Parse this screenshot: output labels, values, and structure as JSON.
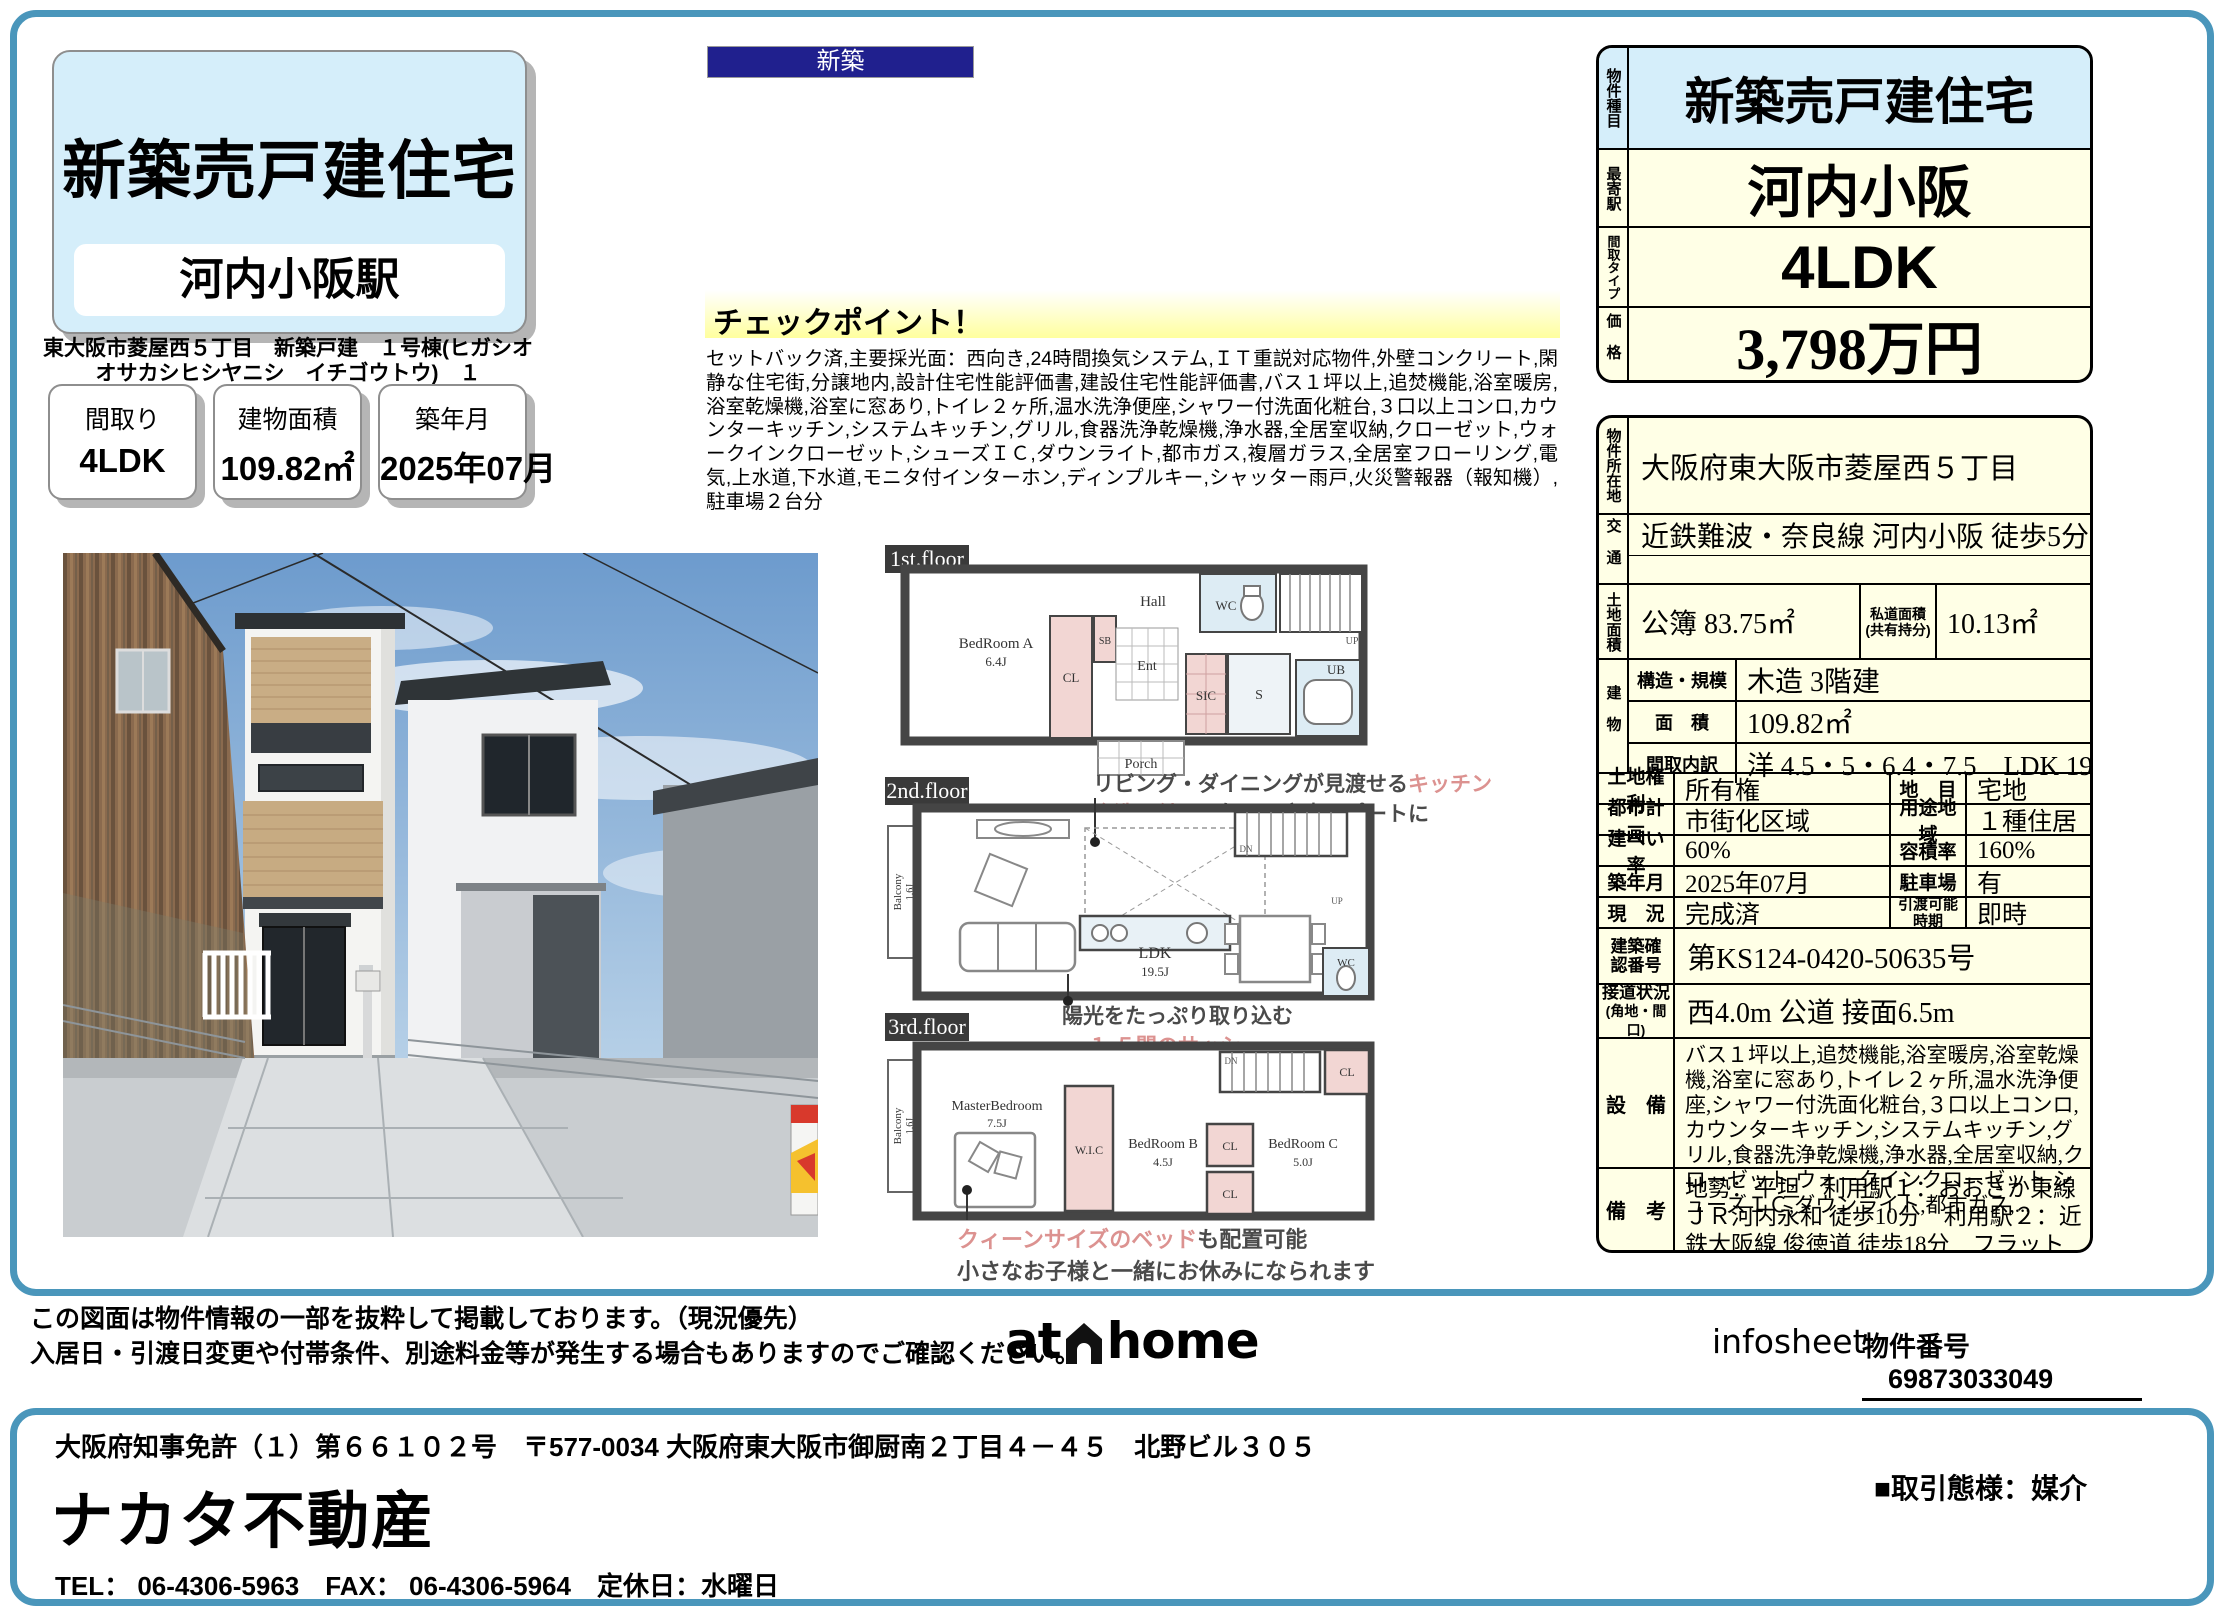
{
  "header": {
    "badge": "新築",
    "title": "新築売戸建住宅",
    "station": "河内小阪駅",
    "address": "東大阪市菱屋西５丁目　新築戸建　１号棟(ヒガシオオサカシヒシヤニシ　イチゴウトウ)　１",
    "stats": [
      {
        "label": "間取り",
        "value": "4LDK"
      },
      {
        "label": "建物面積",
        "value": "109.82㎡"
      },
      {
        "label": "築年月",
        "value": "2025年07月"
      }
    ]
  },
  "checkpoint": {
    "title": "チェックポイント！",
    "body": "セットバック済,主要採光面：西向き,24時間換気システム,ＩＴ重説対応物件,外壁コンクリート,閑静な住宅街,分譲地内,設計住宅性能評価書,建設住宅性能評価書,バス１坪以上,追焚機能,浴室暖房,浴室乾燥機,浴室に窓あり,トイレ２ヶ所,温水洗浄便座,シャワー付洗面化粧台,３口以上コンロ,カウンターキッチン,システムキッチン,グリル,食器洗浄乾燥機,浄水器,全居室収納,クローゼット,ウォークインクローゼット,シューズＩＣ,ダウンライト,都市ガス,複層ガラス,全居室フローリング,電気,上水道,下水道,モニタ付インターホン,ディンプルキー,シャッター雨戸,火災警報器（報知機）,駐車場２台分"
  },
  "summary": {
    "type_label": "物件種目",
    "type_value": "新築売戸建住宅",
    "station_label": "最寄駅",
    "station_value": "河内小阪",
    "layout_label": "間取タイプ",
    "layout_value": "4LDK",
    "price_label": "価格",
    "price_value": "3,798万円"
  },
  "detail": {
    "location": {
      "label": "物件所在地",
      "value": "大阪府東大阪市菱屋西５丁目"
    },
    "access": {
      "label": "交通",
      "value": "近鉄難波・奈良線 河内小阪 徒歩5分"
    },
    "land": {
      "label": "土地面積",
      "value": "公簿 83.75㎡",
      "sub_label1": "私道面積",
      "sub_label2": "(共有持分)",
      "sub_value": "10.13㎡"
    },
    "building": {
      "label": "建物",
      "structure_label": "構造・規模",
      "structure": "木造 3階建",
      "area_label": "面　積",
      "area": "109.82㎡",
      "layout_label": "間取内訳",
      "layout": "洋 4.5・5・6.4・7.5　LDK 19.5"
    },
    "pairs": [
      {
        "l1": "土地権利",
        "v1": "所有権",
        "l2": "地　目",
        "v2": "宅地"
      },
      {
        "l1": "都市計画",
        "v1": "市街化区域",
        "l2": "用途地域",
        "v2": "１種住居"
      },
      {
        "l1": "建ぺい率",
        "v1": "60%",
        "l2": "容積率",
        "v2": "160%"
      },
      {
        "l1": "築年月",
        "v1": "2025年07月",
        "l2": "駐車場",
        "v2": "有"
      },
      {
        "l1": "現　況",
        "v1": "完成済",
        "l2": "引渡可能時期",
        "v2": "即時"
      }
    ],
    "confirm": {
      "label": "建築確認番号",
      "value": "第KS124-0420-50635号"
    },
    "road": {
      "label": "接道状況",
      "label2": "(角地・間口)",
      "value": "西4.0m 公道 接面6.5m"
    },
    "equip": {
      "label": "設　備",
      "value": "バス１坪以上,追焚機能,浴室暖房,浴室乾燥機,浴室に窓あり,トイレ２ヶ所,温水洗浄便座,シャワー付洗面化粧台,３口以上コンロ,カウンターキッチン,システムキッチン,グリル,食器洗浄乾燥機,浄水器,全居室収納,クローゼット,ウォークインクローゼット,シューズＩＣ,ダウンライト,都市ガス,..."
    },
    "notes": {
      "label": "備　考",
      "value": "地勢：平坦　利用駅１：おおさか東線 ＪＲ河内永和 徒歩10分　利用駅２：近鉄大阪線 俊徳道 徒歩18分　フラット35Ｓ適合証明書あり"
    }
  },
  "floors": {
    "f1": {
      "badge": "1st.floor",
      "bedroomA": "BedRoom A",
      "bedroomA_size": "6.4J",
      "hall": "Hall",
      "ent": "Ent",
      "cl": "CL",
      "sb": "SB",
      "sic": "SIC",
      "s": "S",
      "wc": "WC",
      "ub": "UB",
      "porch": "Porch",
      "up": "UP"
    },
    "f2": {
      "badge": "2nd.floor",
      "balcony": "Balcony",
      "balcony_size": "1.6J",
      "ldk": "LDK",
      "ldk_size": "19.5J",
      "wc": "WC",
      "dn": "DN",
      "up": "UP",
      "ann_top_1a": "リビング・ダイニングが見渡せる",
      "ann_top_1b": "キッチン",
      "ann_top_2a": "食洗器付き",
      "ann_top_2b": "で毎日の家事サポートに",
      "ann_bottom_1": "陽光をたっぷり取り込む",
      "ann_bottom_2": "１.５間のサッシ"
    },
    "f3": {
      "badge": "3rd.floor",
      "balcony": "Balcony",
      "balcony_size": "1.6J",
      "master": "MasterBedroom",
      "master_size": "7.5J",
      "wic": "W.I.C",
      "bedroomB": "BedRoom B",
      "bedroomB_size": "4.5J",
      "bedroomC": "BedRoom C",
      "bedroomC_size": "5.0J",
      "cl": "CL",
      "dn": "DN",
      "ann_1a": "クィーンサイズのベッド",
      "ann_1b": "も配置可能",
      "ann_2": "小さなお子様と一緒にお休みになられます"
    }
  },
  "footer": {
    "note1": "この図面は物件情報の一部を抜粋して掲載しております。（現況優先）",
    "note2": "入居日・引渡日変更や付帯条件、別途料金等が発生する場合もありますのでご確認ください。",
    "logo_at": "at",
    "logo_home": "home",
    "infosheet": "infosheet",
    "property_no_label": "物件番号",
    "property_no": "69873033049"
  },
  "company": {
    "license": "大阪府知事免許（１）第６６１０２号　〒577-0034 大阪府東大阪市御厨南２丁目４－４５　北野ビル３０５",
    "name": "ナカタ不動産",
    "contact": "TEL： 06-4306-5963　FAX： 06-4306-5964　定休日：水曜日",
    "transaction": "■取引態様：媒介"
  }
}
